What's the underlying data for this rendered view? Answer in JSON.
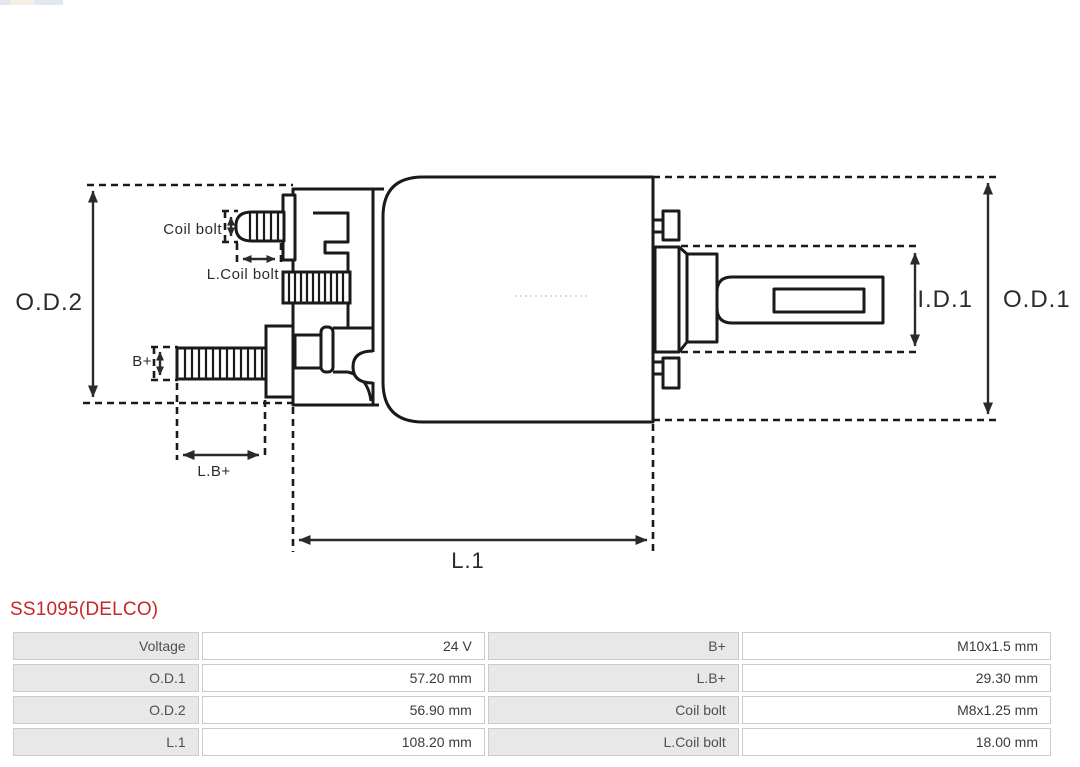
{
  "product": {
    "title": "SS1095(DELCO)",
    "title_color": "#c62828"
  },
  "diagram": {
    "type": "technical-drawing-solenoid-side-view",
    "line_color": "#1a1a1a",
    "labels": {
      "od2": "O.D.2",
      "od1": "O.D.1",
      "id1": "I.D.1",
      "l1": "L.1",
      "coil_bolt": "Coil bolt",
      "l_coil_bolt": "L.Coil bolt",
      "b_plus": "B+",
      "l_b_plus": "L.B+"
    }
  },
  "spec_table": {
    "rows": [
      {
        "label1": "Voltage",
        "value1": "24 V",
        "label2": "B+",
        "value2": "M10x1.5 mm"
      },
      {
        "label1": "O.D.1",
        "value1": "57.20 mm",
        "label2": "L.B+",
        "value2": "29.30 mm"
      },
      {
        "label1": "O.D.2",
        "value1": "56.90 mm",
        "label2": "Coil bolt",
        "value2": "M8x1.25 mm"
      },
      {
        "label1": "L.1",
        "value1": "108.20 mm",
        "label2": "L.Coil bolt",
        "value2": "18.00 mm"
      }
    ]
  }
}
